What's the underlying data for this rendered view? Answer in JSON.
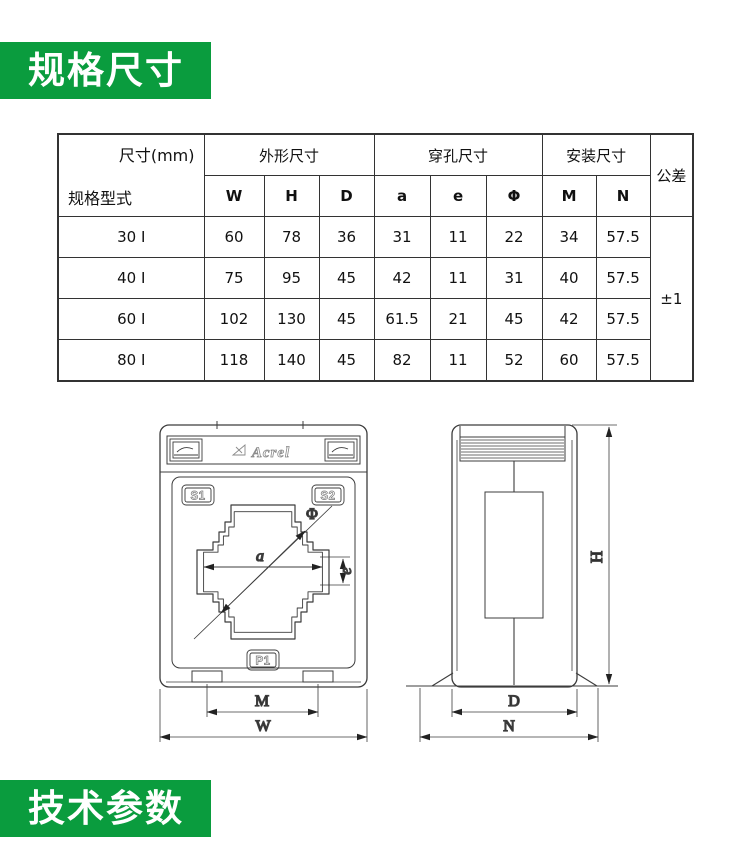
{
  "sections": {
    "spec_title": "规格尺寸",
    "tech_title": "技术参数"
  },
  "theme": {
    "accent_green": "#0a9c3e",
    "banner_text_color": "#ffffff",
    "drawing_line_color": "#3c3c3c"
  },
  "table": {
    "corner": {
      "top_right": "尺寸(mm)",
      "bottom_left": "规格型式"
    },
    "groups": [
      "外形尺寸",
      "穿孔尺寸",
      "安装尺寸"
    ],
    "tolerance_header": "公差",
    "subheaders": [
      "W",
      "H",
      "D",
      "a",
      "e",
      "Φ",
      "M",
      "N"
    ],
    "rows": [
      {
        "model": "30 I",
        "values": [
          "60",
          "78",
          "36",
          "31",
          "11",
          "22",
          "34",
          "57.5"
        ]
      },
      {
        "model": "40 I",
        "values": [
          "75",
          "95",
          "45",
          "42",
          "11",
          "31",
          "40",
          "57.5"
        ]
      },
      {
        "model": "60 I",
        "values": [
          "102",
          "130",
          "45",
          "61.5",
          "21",
          "45",
          "42",
          "57.5"
        ]
      },
      {
        "model": "80 I",
        "values": [
          "118",
          "140",
          "45",
          "82",
          "11",
          "52",
          "60",
          "57.5"
        ]
      }
    ],
    "tolerance_value": "±1"
  },
  "drawing": {
    "front": {
      "brand": "Acrel",
      "terminal_s1": "S1",
      "terminal_s2": "S2",
      "terminal_p1": "P1",
      "dim_a": "a",
      "dim_phi": "Φ",
      "dim_e": "e",
      "dim_m": "M",
      "dim_w": "W"
    },
    "side": {
      "dim_h": "H",
      "dim_d": "D",
      "dim_n": "N"
    }
  }
}
